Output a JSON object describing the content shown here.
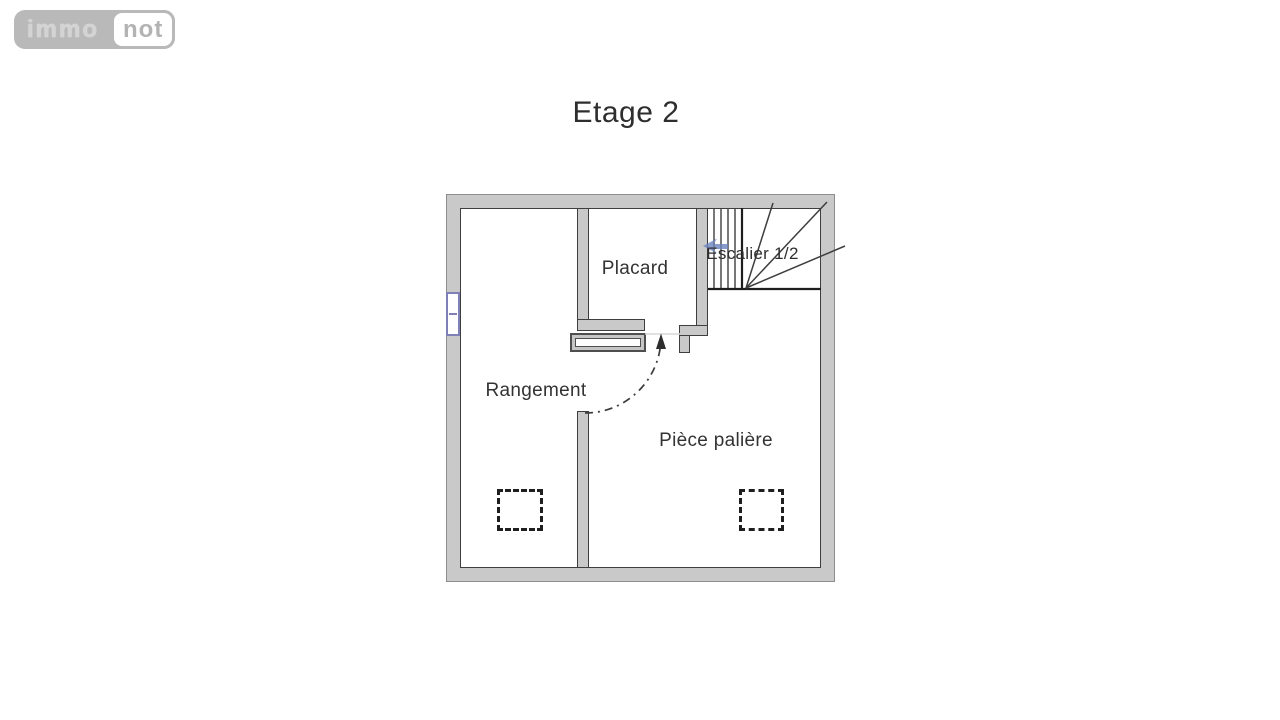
{
  "logo": {
    "immo": "immo",
    "not": "not"
  },
  "title": "Etage 2",
  "rooms": {
    "placard": "Placard",
    "rangement": "Rangement",
    "piece_paliere": "Pièce palière",
    "escalier": "Escalier 1/2"
  },
  "colors": {
    "wall_fill": "#c9c9c9",
    "wall_edge": "#3e3e3e",
    "window_blue": "#8080b8",
    "direction_arrow_blue": "#6b85c0",
    "label_text": "#333333",
    "logo_gray": "#b9b9b9"
  }
}
